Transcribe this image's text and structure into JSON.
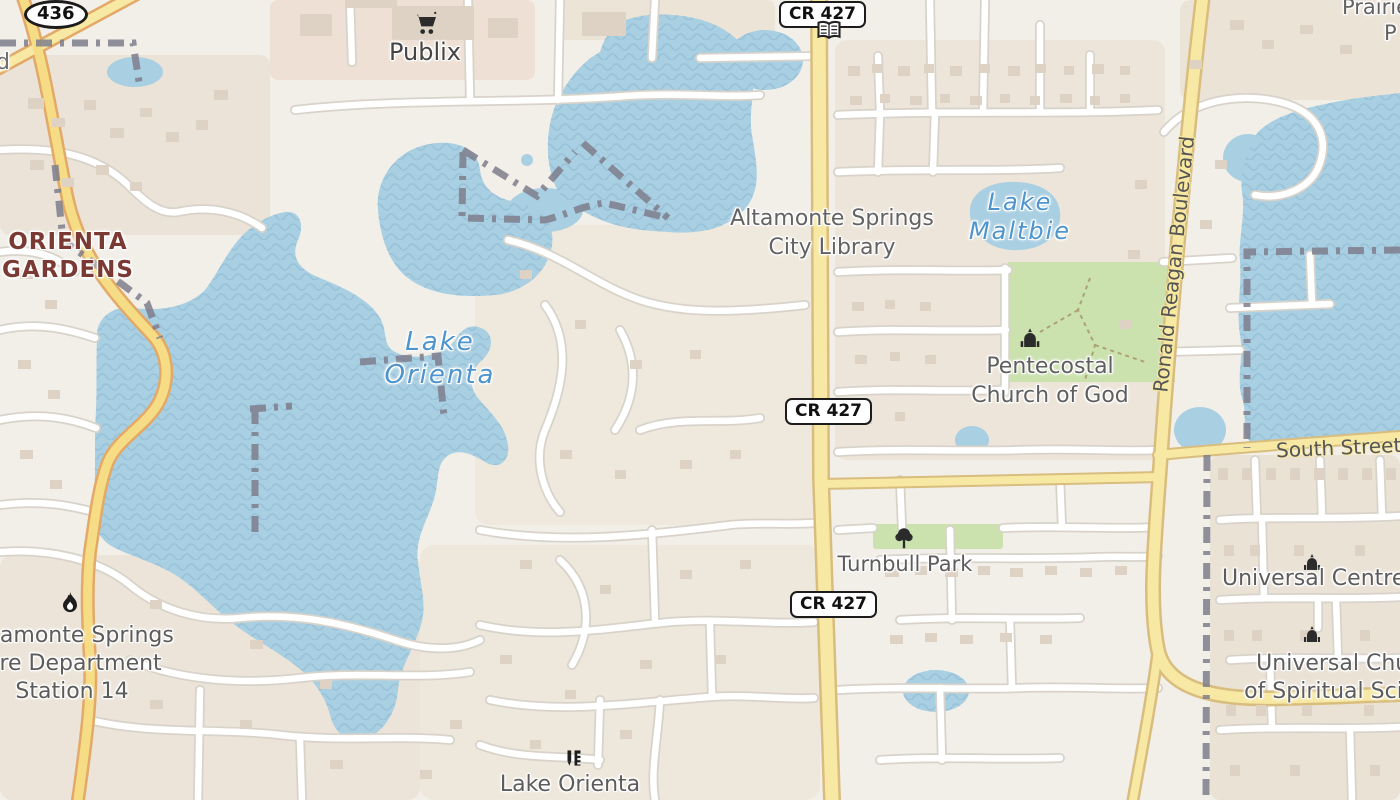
{
  "map": {
    "route_badges": {
      "sr436": "436",
      "cr427": "CR 427"
    },
    "labels": {
      "publix": "Publix",
      "orienta_gardens": {
        "line1": "ORIENTA",
        "line2": "GARDENS"
      },
      "lake_orienta": {
        "line1": "Lake",
        "line2": "Orienta"
      },
      "library": {
        "line1": "Altamonte Springs",
        "line2": "City Library"
      },
      "lake_maltbie": {
        "line1": "Lake",
        "line2": "Maltbie"
      },
      "pentecostal": {
        "line1": "Pentecostal",
        "line2": "Church of God"
      },
      "ronald_reagan": "Ronald Reagan Boulevard",
      "south_street": "South Street",
      "turnbull_park": "Turnbull Park",
      "universal_centre": "Universal Centre",
      "universal_church": {
        "line1": "Universal Church",
        "line2": "of Spiritual Science"
      },
      "fire_station": {
        "line1": "Altamonte Springs",
        "line2": "Fire Department",
        "line3": "Station 14"
      },
      "lake_orienta_poi": "Lake Orienta",
      "prairie_partial": {
        "line1": "Prairie",
        "line2": "P"
      },
      "road_partial_d": "d"
    },
    "icons": [
      "supermarket-cart-icon",
      "library-book-icon",
      "church-icon",
      "tree-icon",
      "fire-icon",
      "school-icon"
    ],
    "colors": {
      "background": "#f2efe9",
      "water": "#a9cfe2",
      "water_wave": "#9ac2d8",
      "water_label": "#4f94cd",
      "major_road_fill": "#f7e9a3",
      "major_road_casing": "#d9bd7e",
      "orange_road_casing": "#e2a968",
      "minor_road_fill": "#ffffff",
      "minor_road_casing": "#d8d3ca",
      "park": "#cbe2af",
      "boundary": "#7e7e8c",
      "place_label": "#7a3a33",
      "poi_label": "#5c5c5c"
    }
  }
}
